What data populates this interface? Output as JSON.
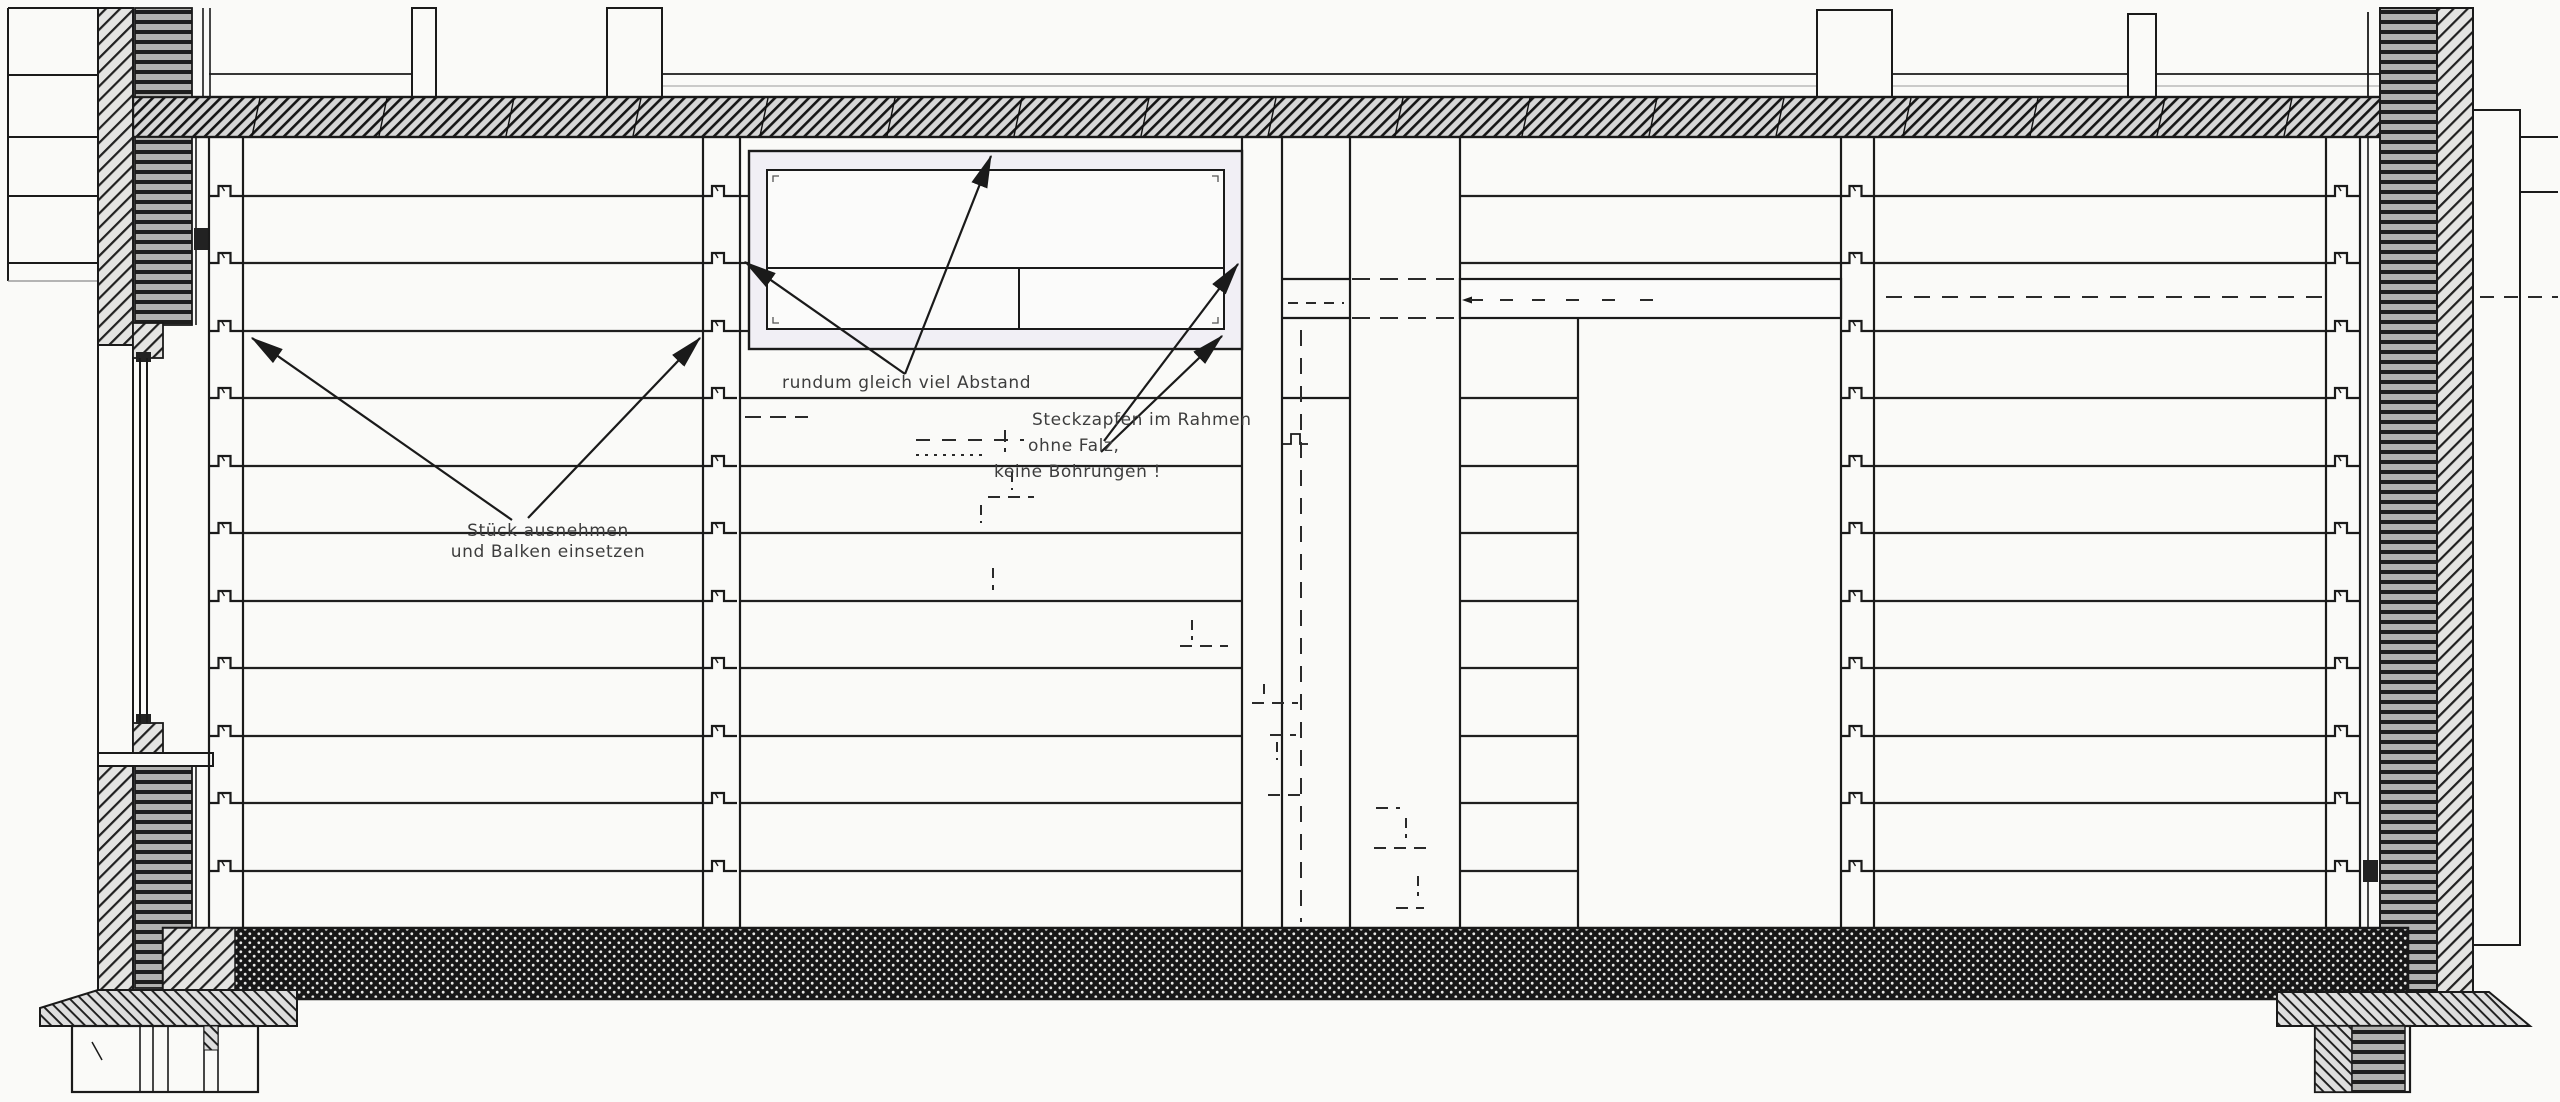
{
  "drawing": {
    "kind": "timber log-wall construction section (Blockbohlenwand) with window frame and door opening",
    "language": "de"
  },
  "annotations": {
    "note_left": {
      "line1": "Stück ausnehmen",
      "line2": "und Balken einsetzen"
    },
    "note_window": {
      "text": "rundum gleich viel Abstand"
    },
    "note_frame": {
      "line1": "Steckzapfen im Rahmen",
      "line2": "ohne Falz,",
      "line3": "keine Bohrungen !"
    }
  },
  "palette": {
    "paper": "#fafaf8",
    "ink": "#1a1a1a",
    "beam_fill": "#d7d7d7",
    "stripe_dark": "#1e1e1e",
    "stripe_light": "#b2b2b0",
    "sill_base": "#171717",
    "sill_dot": "#e8e8e6",
    "hatch_light": "#e4e4e2",
    "frame_tint": "#f1eff5",
    "text": "#3d3d3d"
  }
}
